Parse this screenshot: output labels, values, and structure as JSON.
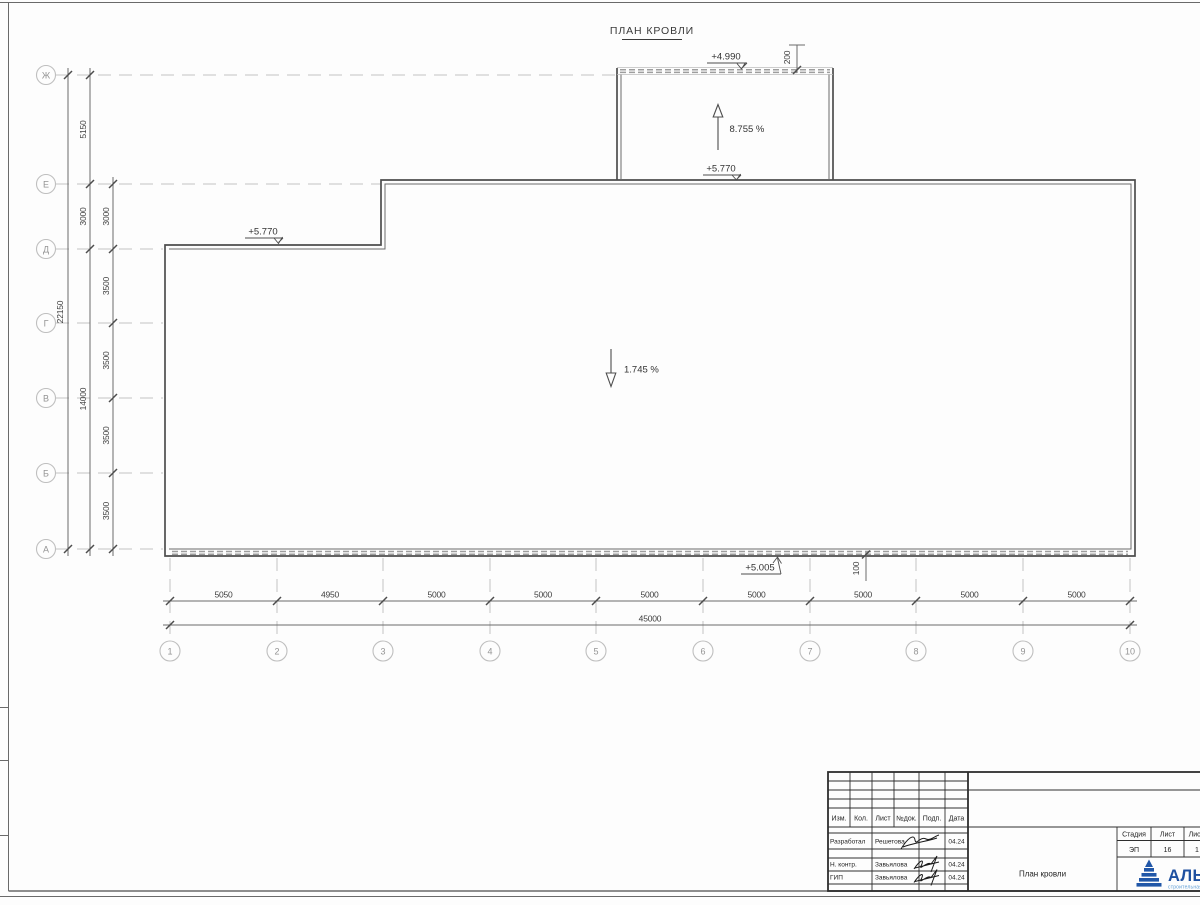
{
  "page": {
    "title": "ПЛАН КРОВЛИ"
  },
  "axes": {
    "rows": [
      "Ж",
      "Е",
      "Д",
      "Г",
      "В",
      "Б",
      "А"
    ],
    "cols": [
      "1",
      "2",
      "3",
      "4",
      "5",
      "6",
      "7",
      "8",
      "9",
      "10"
    ]
  },
  "dimensions": {
    "left_total": "22150",
    "left_outer": [
      "5150",
      "3000",
      "14000"
    ],
    "left_inner": [
      "3000",
      "3500",
      "3500",
      "3500",
      "3500"
    ],
    "bottom_segments": [
      "5050",
      "4950",
      "5000",
      "5000",
      "5000",
      "5000",
      "5000",
      "5000",
      "5000"
    ],
    "bottom_total": "45000",
    "offset_top": "200",
    "offset_bottom": "100"
  },
  "marks": {
    "elev_upper_top": "+4.990",
    "elev_upper_bottom": "+5.770",
    "elev_left": "+5.770",
    "elev_bottom": "+5.005",
    "slope_upper": "8.755 %",
    "slope_main": "1.745 %"
  },
  "titleblock": {
    "header": [
      "Изм.",
      "Кол.",
      "Лист",
      "№док.",
      "Подп.",
      "Дата"
    ],
    "rows": [
      {
        "role": "Разработал",
        "name": "Решетова",
        "date": "04.24"
      },
      {
        "role": "Н. контр.",
        "name": "Завьялова",
        "date": "04.24"
      },
      {
        "role": "ГИП",
        "name": "Завьялова",
        "date": "04.24"
      }
    ],
    "doc_name": "План кровли",
    "stage_table": {
      "headers": [
        "Стадия",
        "Лист",
        "Листов"
      ],
      "values": [
        "ЭП",
        "16",
        "1"
      ]
    },
    "logo": {
      "name": "АЛЬЯНС",
      "tagline": "строительная компания"
    }
  },
  "colors": {
    "line_dark": "#4d4d4d",
    "grid_gray": "#c4c4c4",
    "parapet_gray": "#9e9e9e",
    "logo_blue": "#2157a8",
    "logo_light_blue": "#5b9bd5"
  }
}
